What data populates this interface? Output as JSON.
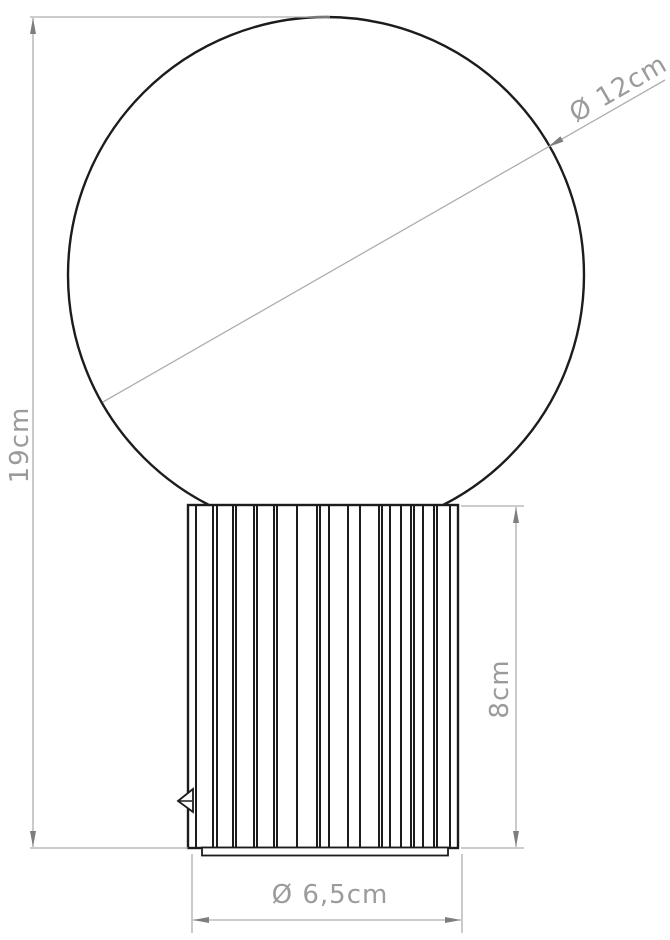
{
  "drawing": {
    "type": "technical-dimension-diagram",
    "object": "table lamp with spherical globe shade on a ribbed cylindrical base",
    "rib_positions": [
      196,
      213,
      217,
      233,
      236,
      254,
      257,
      274,
      277,
      297,
      317,
      320,
      329,
      348,
      360,
      379,
      382,
      390,
      401,
      411,
      414,
      423,
      434,
      437,
      450
    ],
    "rib_top": 506,
    "rib_bottom": 847
  },
  "dimensions": {
    "sphere_diameter": {
      "label": "Ø 12cm",
      "value_cm": 12,
      "orientation": "diagonal"
    },
    "total_height": {
      "label": "19cm",
      "value_cm": 19,
      "orientation": "vertical-left"
    },
    "base_height": {
      "label": "8cm",
      "value_cm": 8,
      "orientation": "vertical-right"
    },
    "base_diameter": {
      "label": "Ø 6,5cm",
      "value_cm": 6.5,
      "orientation": "horizontal-bottom"
    }
  },
  "colors": {
    "outline": "#1c1c1c",
    "dimension_line": "#aeaeae",
    "arrow": "#7e7e7e",
    "label_text": "#9b9b9b",
    "background": "#ffffff"
  }
}
